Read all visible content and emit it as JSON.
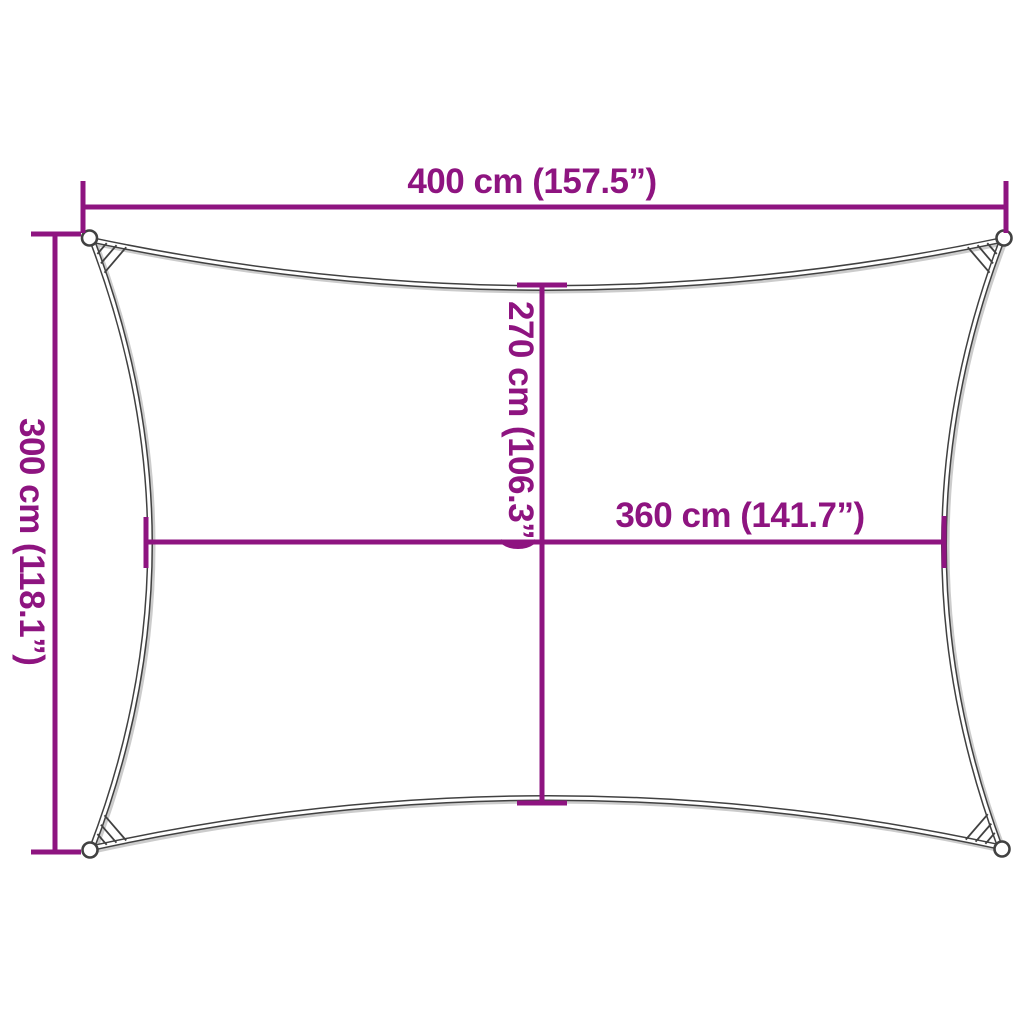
{
  "labels": {
    "width": "400 cm (157.5”)",
    "height": "300 cm (118.1”)",
    "inner_height": "270 cm (106.3”)",
    "inner_width": "360 cm (141.7”)"
  },
  "colors": {
    "accent": "#8E1480",
    "outline": "#414141",
    "background": "#FFFFFF"
  }
}
